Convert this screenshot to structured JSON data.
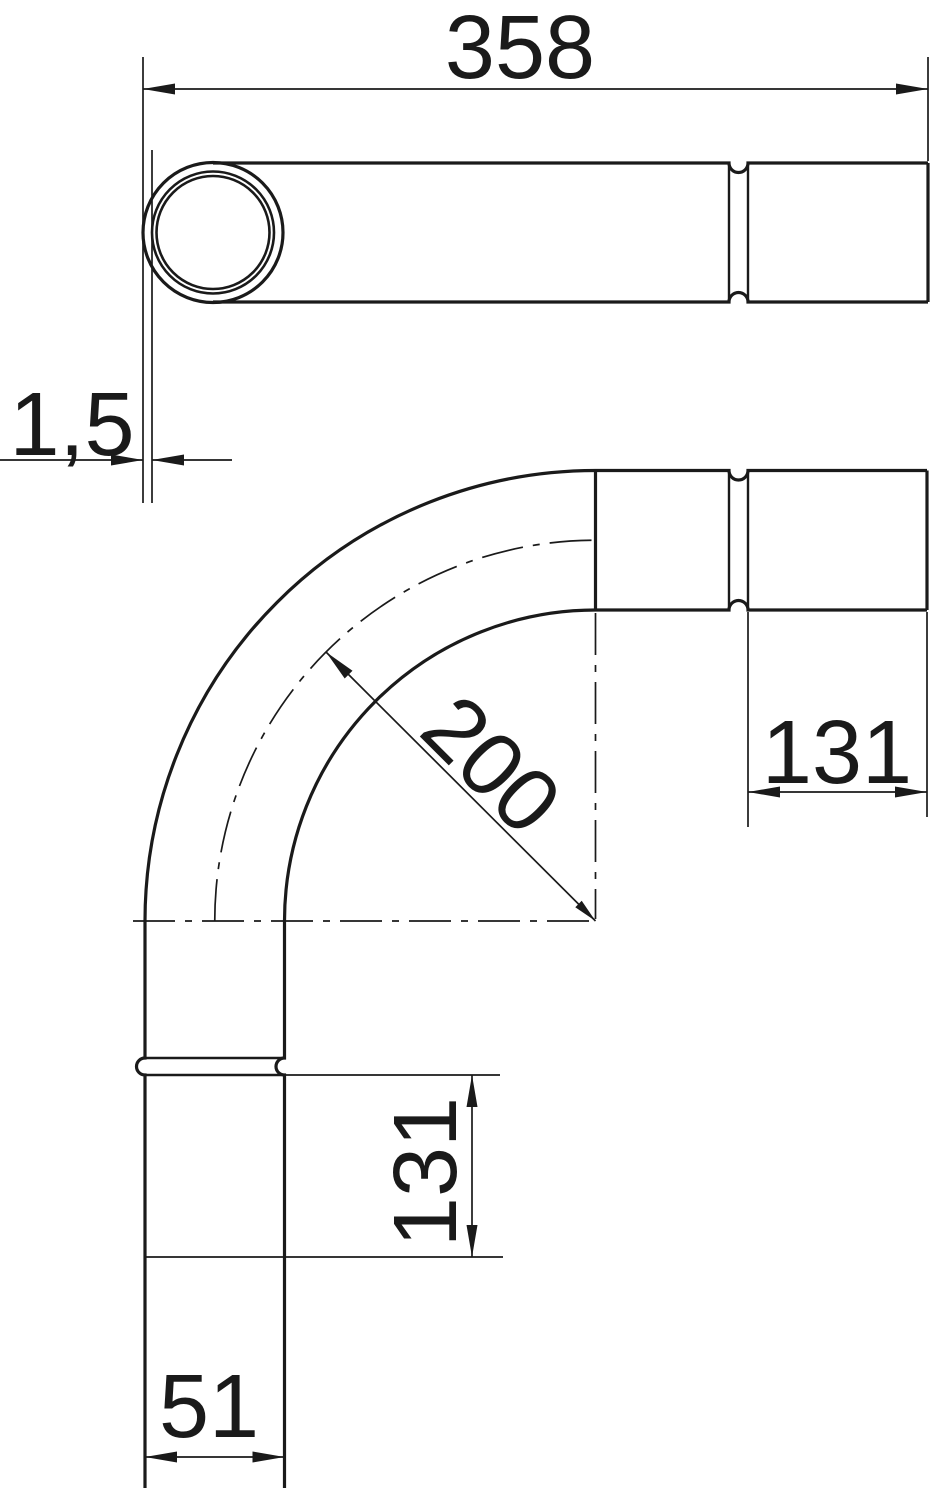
{
  "colors": {
    "ink": "#1a1a1a",
    "background": "#ffffff"
  },
  "drawing": {
    "dimensions": {
      "total_length": "358",
      "wall_thickness": "1,5",
      "bend_radius": "200",
      "plain_end_length_right": "131",
      "plain_end_length_bottom": "131",
      "socket_width": "51"
    }
  }
}
